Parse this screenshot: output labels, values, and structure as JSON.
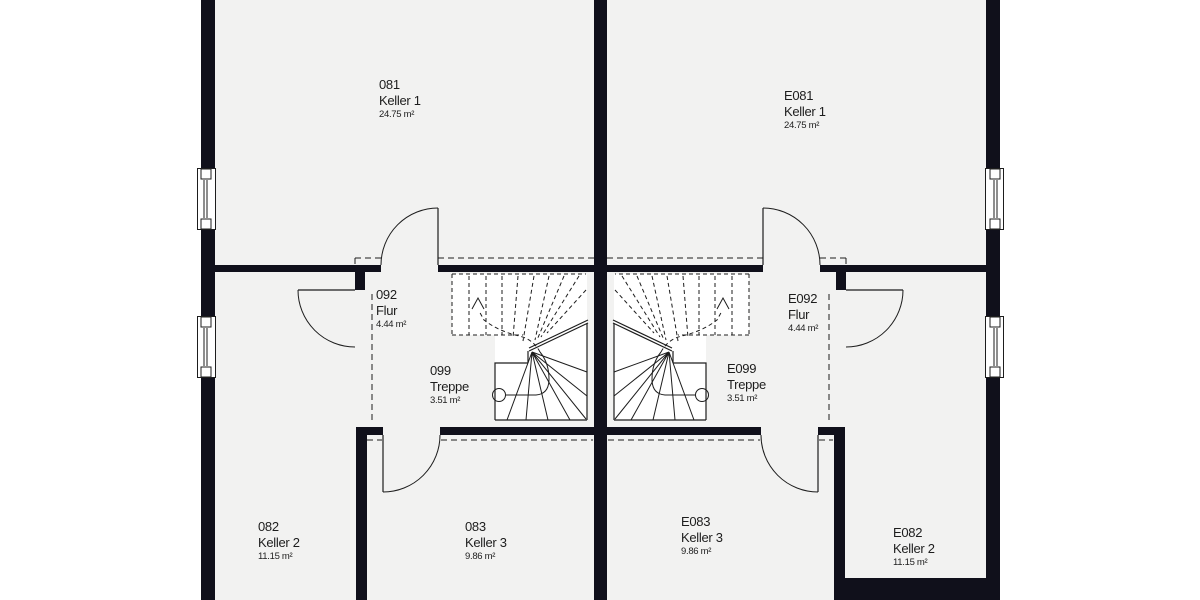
{
  "colors": {
    "wall": "#10101b",
    "line": "#1d1d1d",
    "room_fill": "#f2f2f1",
    "background": "#ffffff"
  },
  "plan_type": "basement floor plan (Kellergeschoss), semi-detached house, mirrored units",
  "rooms": [
    {
      "id": "081",
      "name": "Keller 1",
      "area": "24.75 m²"
    },
    {
      "id": "092",
      "name": "Flur",
      "area": "4.44 m²"
    },
    {
      "id": "099",
      "name": "Treppe",
      "area": "3.51 m²"
    },
    {
      "id": "082",
      "name": "Keller 2",
      "area": "11.15 m²"
    },
    {
      "id": "083",
      "name": "Keller 3",
      "area": "9.86 m²"
    },
    {
      "id": "E081",
      "name": "Keller 1",
      "area": "24.75 m²"
    },
    {
      "id": "E092",
      "name": "Flur",
      "area": "4.44 m²"
    },
    {
      "id": "E099",
      "name": "Treppe",
      "area": "3.51 m²"
    },
    {
      "id": "E083",
      "name": "Keller 3",
      "area": "9.86 m²"
    },
    {
      "id": "E082",
      "name": "Keller 2",
      "area": "11.15 m²"
    }
  ]
}
